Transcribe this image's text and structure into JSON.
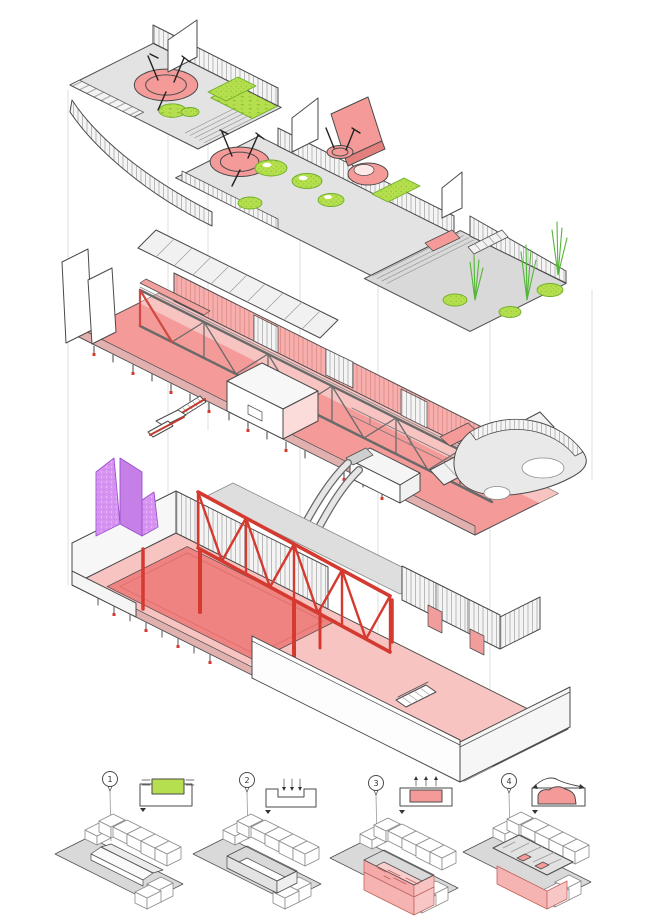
{
  "drawing": {
    "type": "exploded-axonometric-architecture-diagram",
    "levels": [
      {
        "name": "roof-playscape"
      },
      {
        "name": "upper-hall-trusses"
      },
      {
        "name": "lower-hall-court"
      }
    ]
  },
  "legend": {
    "items": [
      {
        "number": "1",
        "icon": "existing-hall-in-ground-section"
      },
      {
        "number": "2",
        "icon": "excavation-down-arrows-section"
      },
      {
        "number": "3",
        "icon": "pink-program-infill-up-arrows-section"
      },
      {
        "number": "4",
        "icon": "landscape-flow-over-roof-section"
      }
    ]
  },
  "palette": {
    "pink": "#f49b99",
    "pinklight": "#f8c4c2",
    "pinkdark": "#ee8381",
    "pinkpale": "#fbdcda",
    "red": "#d43a2f",
    "reddeep": "#c0392b",
    "green": "#b5df4e",
    "greenstroke": "#6fae2a",
    "grass": "#54b637",
    "purple": "#d794f2",
    "purplestroke": "#9a4fd0",
    "deck": "#e3e3e3",
    "ground": "#d9d9d9",
    "wall": "#f1f1f1",
    "ink": "#4a4a4a",
    "inksoft": "#8a8a8a",
    "guide": "#dcdcdc",
    "white": "#ffffff"
  }
}
